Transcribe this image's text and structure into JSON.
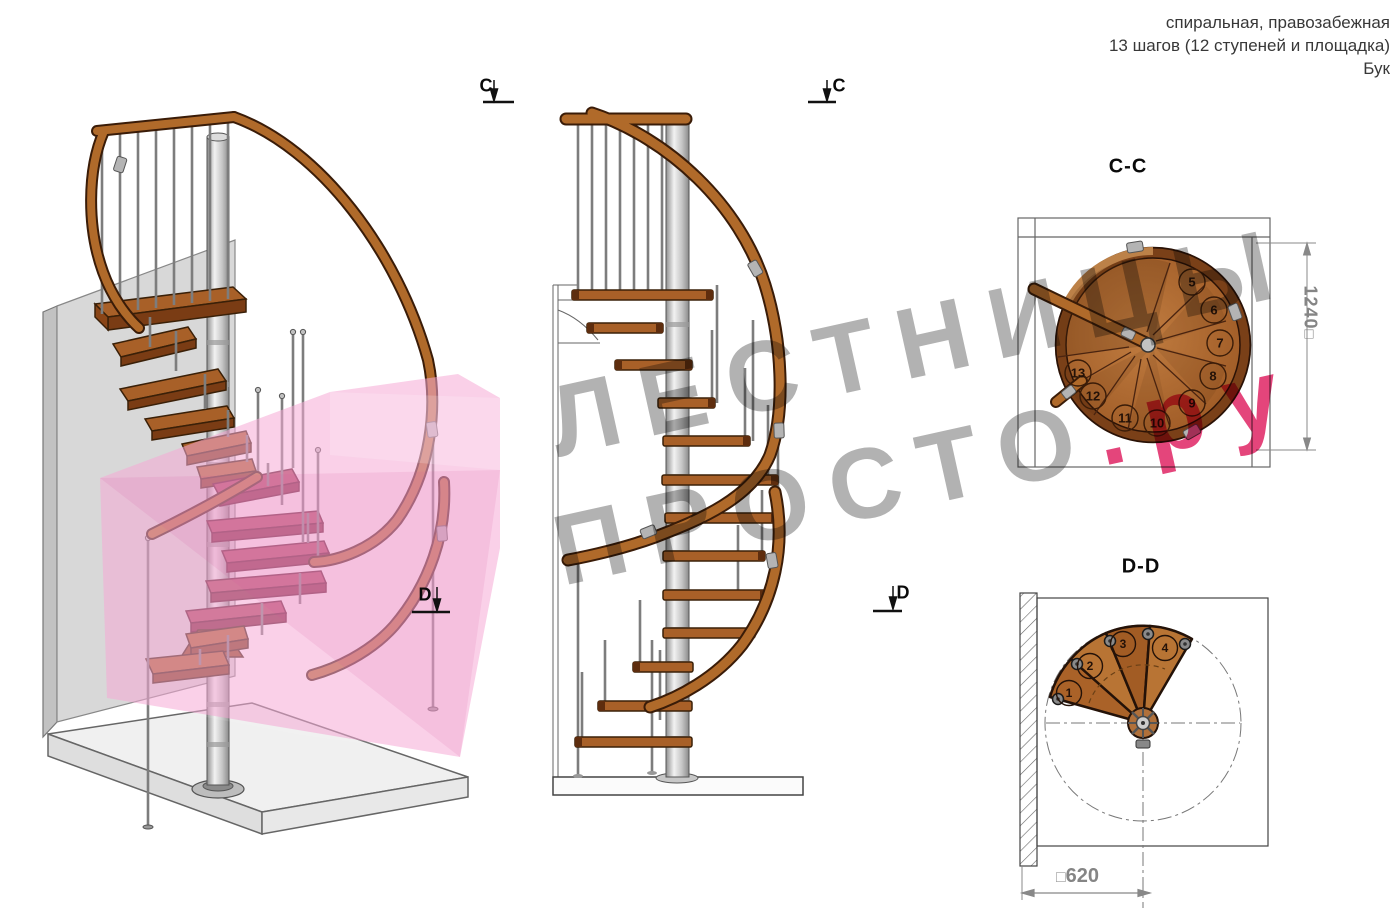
{
  "title": {
    "line1": "спиральная, правозабежная",
    "line2": "13 шагов (12 ступеней и площадка)",
    "line3": "Бук"
  },
  "watermark": {
    "word1": "ЛЕСТНИЦЫ",
    "word2": "ПРОСТО",
    "word2_suffix": ".ру"
  },
  "section_markers": {
    "c": "C",
    "d": "D"
  },
  "cc_view": {
    "label": "C-C",
    "dim_value": "1240",
    "dim_square": "□",
    "step_numbers": [
      "5",
      "6",
      "7",
      "8",
      "9",
      "10",
      "11",
      "12",
      "13"
    ]
  },
  "dd_view": {
    "label": "D-D",
    "dim_value": "620",
    "dim_square": "□",
    "step_numbers": [
      "1",
      "2",
      "3",
      "4"
    ]
  },
  "colors": {
    "wood": "#a86028",
    "wood_dark": "#3a2008",
    "steel": "#b8b8b8",
    "section_highlight_pink": "#f5a9d5",
    "cut_tread_magenta": "#a84158",
    "watermark_gray": "#b2b2b2",
    "watermark_red": "#e23570",
    "dim_gray": "#858585"
  }
}
